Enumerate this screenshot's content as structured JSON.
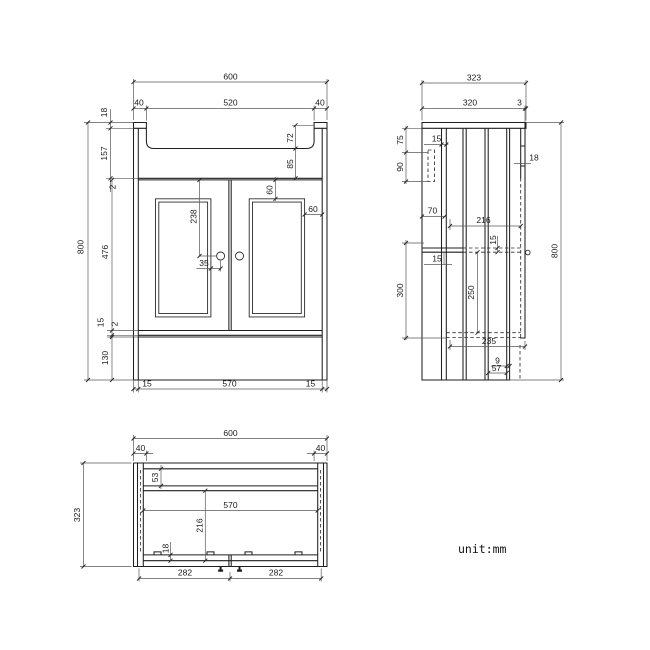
{
  "unit_label": "unit:mm",
  "colors": {
    "line": "#1f1f1f",
    "dim_line": "#5a5a5a",
    "background": "#ffffff"
  },
  "front_view": {
    "overall_width": "600",
    "basin_opening_width": "520",
    "tab_width_left": "40",
    "tab_width_right": "40",
    "top_rail_height": "18",
    "upper_section_height": "157",
    "top_gap": "2",
    "overall_height": "800",
    "basin_depth": "72",
    "basin_to_body": "85",
    "door_height": "476",
    "panel_top_inset": "60",
    "panel_side_inset": "60",
    "knob_drop": "238",
    "knob_offset": "35",
    "bottom_rail_height": "15",
    "bottom_gap": "2",
    "plinth_height": "130",
    "base_side_left": "15",
    "base_width": "570",
    "base_side_right": "15"
  },
  "side_view": {
    "overall_depth": "323",
    "top_depth": "320",
    "front_lip": "3",
    "overall_height": "800",
    "bracket_top_offset": "75",
    "bracket_height": "90",
    "back_panel_thickness": "15",
    "door_thickness": "18",
    "back_clearance": "70",
    "interior_depth": "216",
    "shelf_thickness": "15",
    "rail_thickness": "15",
    "lower_section_height": "300",
    "interior_height": "250",
    "bottom_interior_depth": "235",
    "leg_setback": "9",
    "leg_depth": "57"
  },
  "top_view": {
    "overall_width": "600",
    "tab_width_left": "40",
    "tab_width_right": "40",
    "overall_depth": "323",
    "back_clearance": "53",
    "inner_width": "570",
    "interior_depth": "216",
    "front_rail_thickness": "18",
    "door_width_left": "282",
    "door_width_right": "282"
  }
}
